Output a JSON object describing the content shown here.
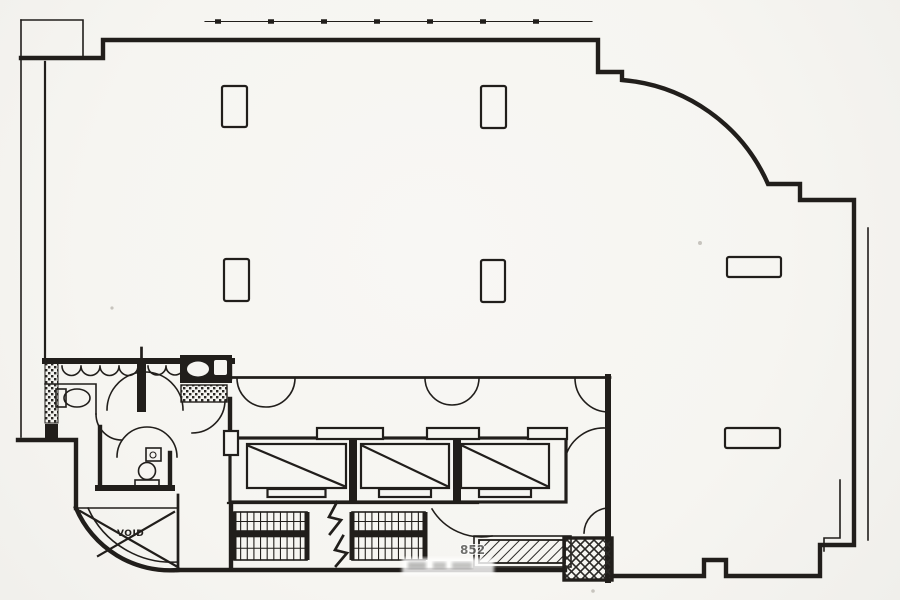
{
  "document": {
    "type": "architectural-floor-plan",
    "description": "Scanned black-and-white office floor plan: open L-shaped floor with curved corners, central service core with three elevators, two stair flights, restrooms, and structural columns"
  },
  "labels": {
    "void": "VOID",
    "watermark": "852"
  },
  "colors": {
    "ink": "#211e1b",
    "paper": "#f6f5f1"
  },
  "core": {
    "elevators": {
      "count": 3,
      "y": 444,
      "h": 44,
      "slot_h": 8,
      "cars": [
        {
          "name": "elevator-1",
          "x": 247,
          "w": 99,
          "slot_w": 58
        },
        {
          "name": "elevator-2",
          "x": 361,
          "w": 88,
          "slot_w": 52
        },
        {
          "name": "elevator-3",
          "x": 461,
          "w": 88,
          "slot_w": 52
        }
      ]
    },
    "stairs": {
      "count": 2,
      "flights": [
        {
          "name": "stair-flight-left",
          "x": 234,
          "w": 73
        },
        {
          "name": "stair-flight-right",
          "x": 352,
          "w": 73
        }
      ],
      "rows": [
        {
          "y": 512,
          "h": 19
        },
        {
          "y": 536.5,
          "h": 23.5
        }
      ],
      "divider": {
        "y": 531,
        "h": 5.5
      },
      "treads_per_row": 11
    }
  },
  "columns": [
    {
      "x": 222,
      "y": 86,
      "w": 25,
      "h": 41
    },
    {
      "x": 481,
      "y": 86,
      "w": 25,
      "h": 42
    },
    {
      "x": 224,
      "y": 259,
      "w": 25,
      "h": 42
    },
    {
      "x": 481,
      "y": 260,
      "w": 24,
      "h": 42
    },
    {
      "x": 727,
      "y": 257,
      "w": 54,
      "h": 20
    },
    {
      "x": 725,
      "y": 428,
      "w": 55,
      "h": 20
    }
  ]
}
